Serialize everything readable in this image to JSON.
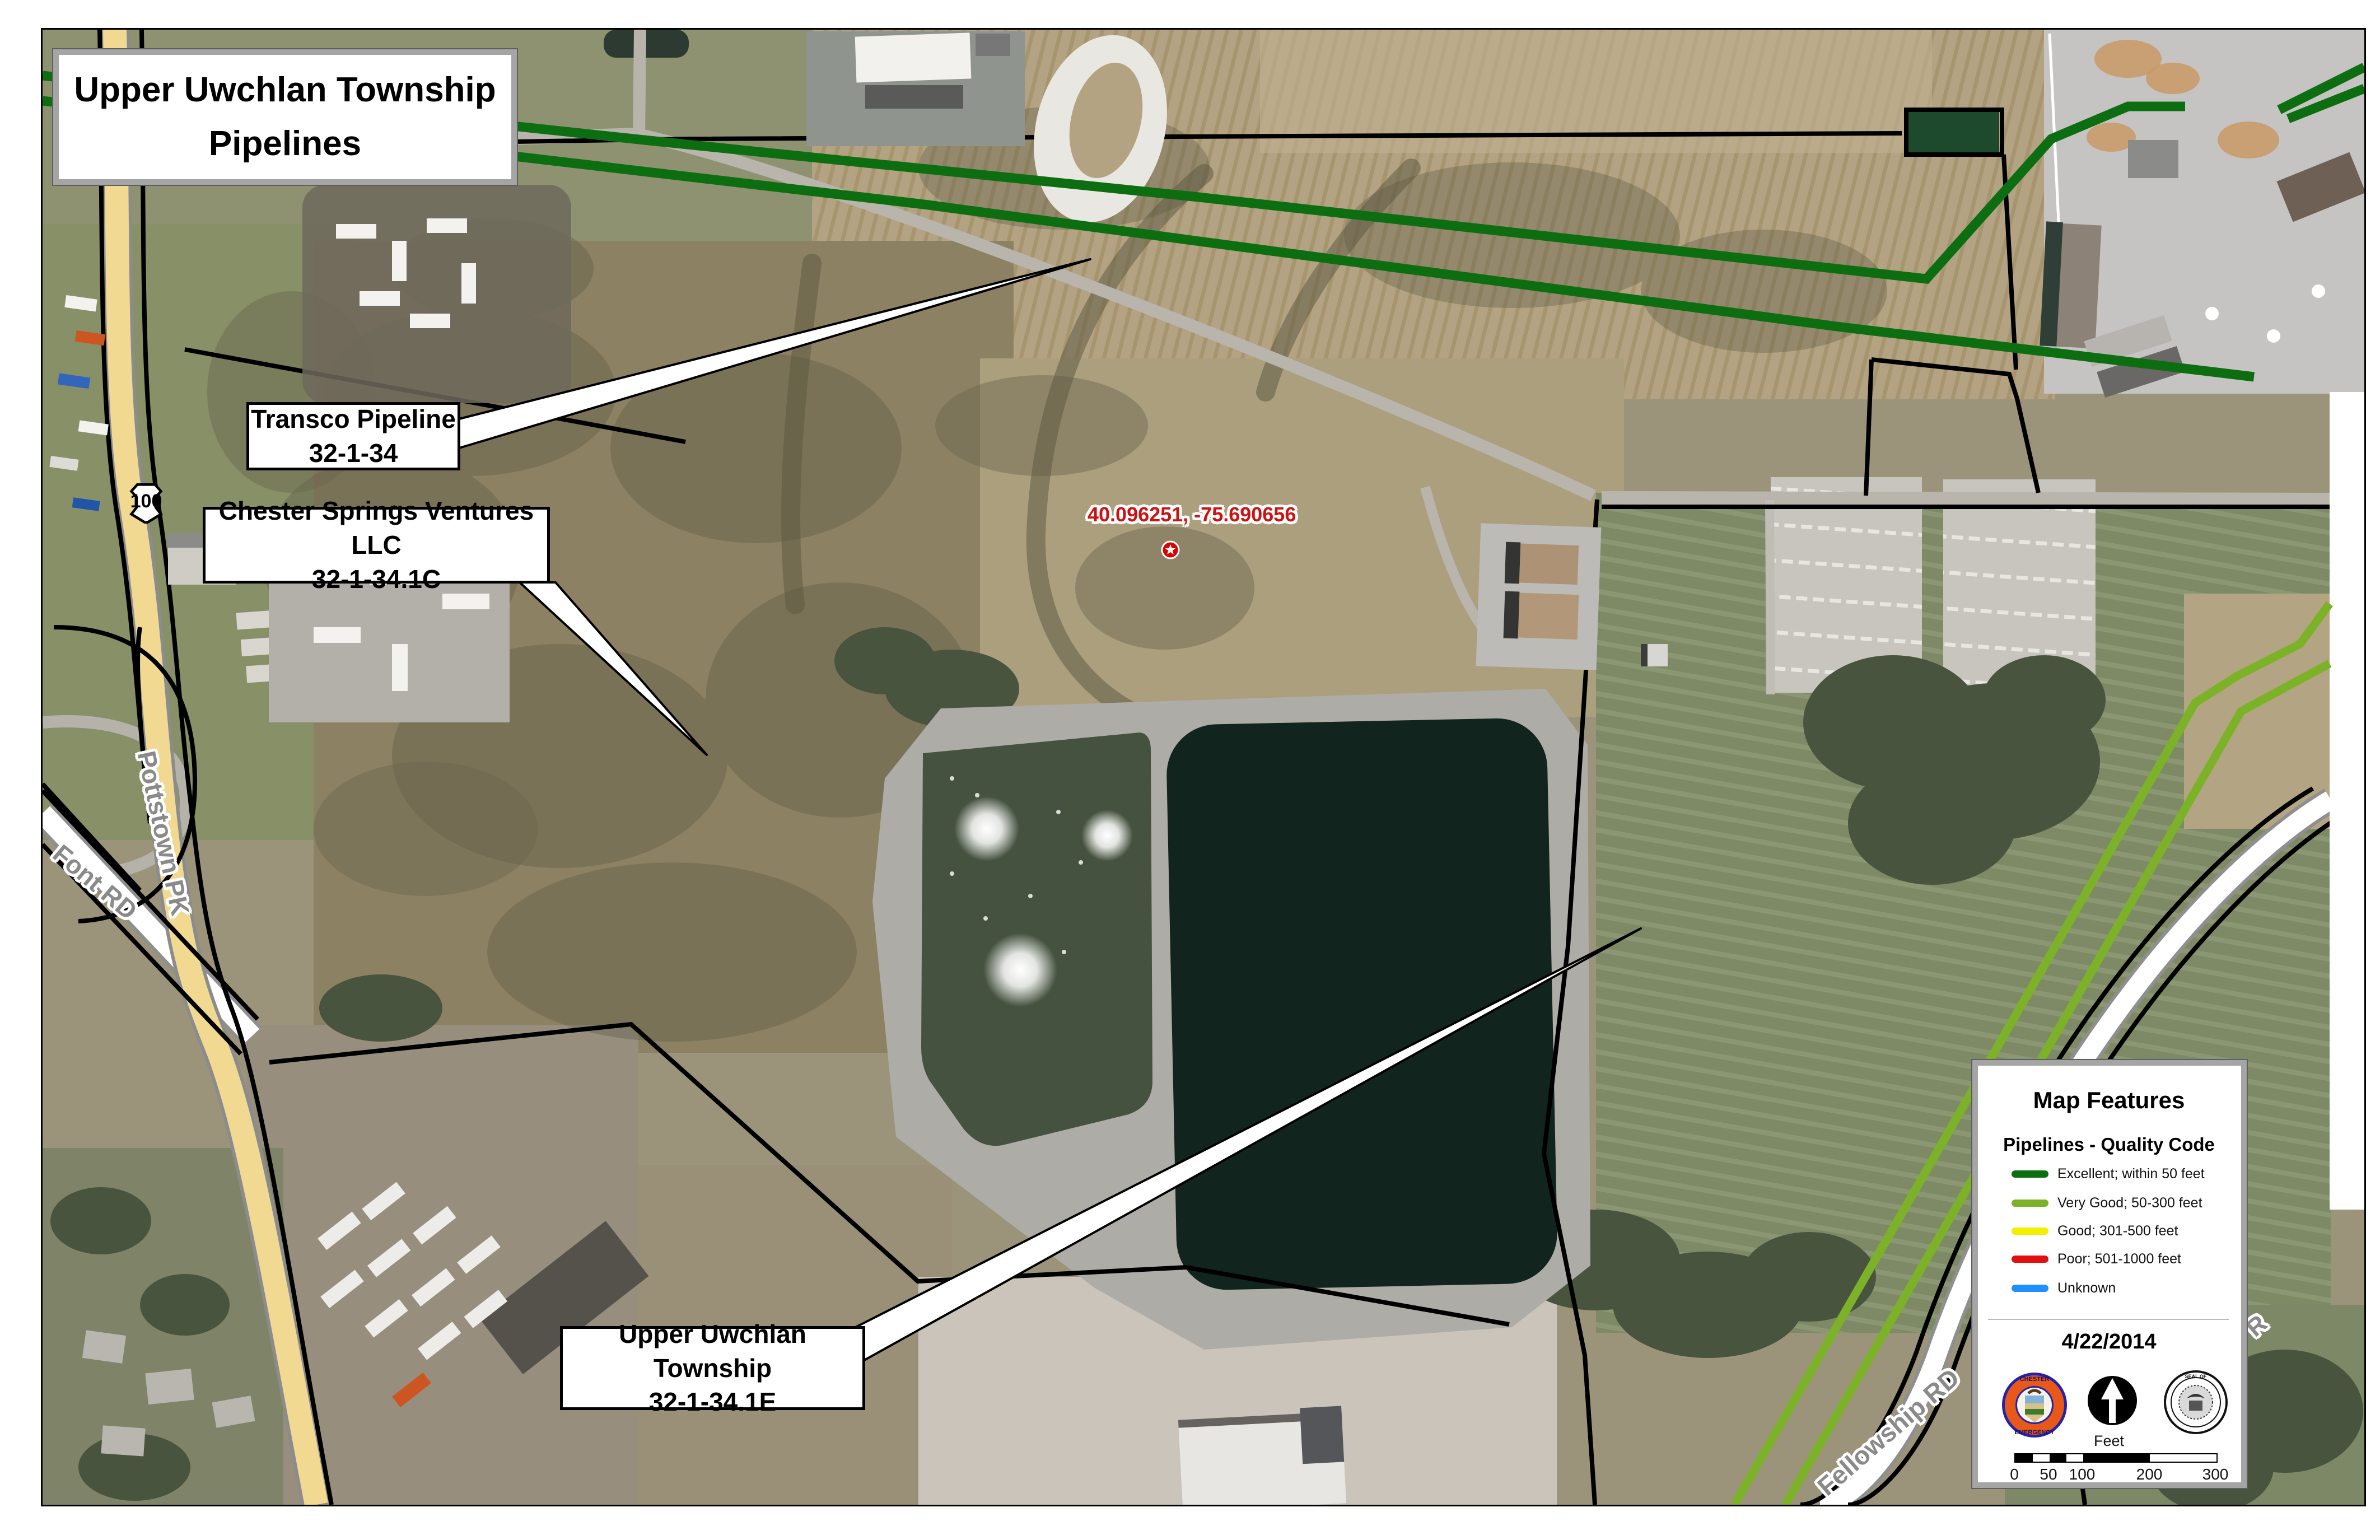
{
  "title_box": {
    "line1": "Upper Uwchlan Township",
    "line2": "Pipelines"
  },
  "callouts": {
    "transco": {
      "line1": "Transco Pipeline",
      "line2": "32-1-34"
    },
    "chester": {
      "line1": "Chester Springs Ventures LLC",
      "line2": "32-1-34.1C"
    },
    "upper": {
      "line1": "Upper Uwchlan Township",
      "line2": "32-1-34.1E"
    }
  },
  "marker": {
    "coordinates": "40.096251, -75.690656",
    "symbol": "red-star-marker"
  },
  "roads": {
    "pottstown": "Pottstown PK",
    "font": "Font RD",
    "fellowship": "Fellowship RD",
    "fragment": "R",
    "route_shield": "100"
  },
  "legend": {
    "title": "Map Features",
    "subtitle": "Pipelines - Quality Code",
    "items": [
      {
        "label": "Excellent; within 50 feet",
        "color": "#0d6e11"
      },
      {
        "label": "Very Good; 50-300 feet",
        "color": "#7cb228"
      },
      {
        "label": "Good; 301-500 feet",
        "color": "#f2ef00"
      },
      {
        "label": "Poor; 501-1000 feet",
        "color": "#e01010"
      },
      {
        "label": "Unknown",
        "color": "#1e90ff"
      }
    ],
    "date": "4/22/2014",
    "scale": {
      "unit": "Feet",
      "ticks": [
        "0",
        "50",
        "100",
        "200",
        "300"
      ]
    },
    "seals": {
      "left": "chester-county-emergency-services-seal",
      "center": "north-arrow",
      "right": "chester-county-pennsylvania-seal"
    }
  }
}
